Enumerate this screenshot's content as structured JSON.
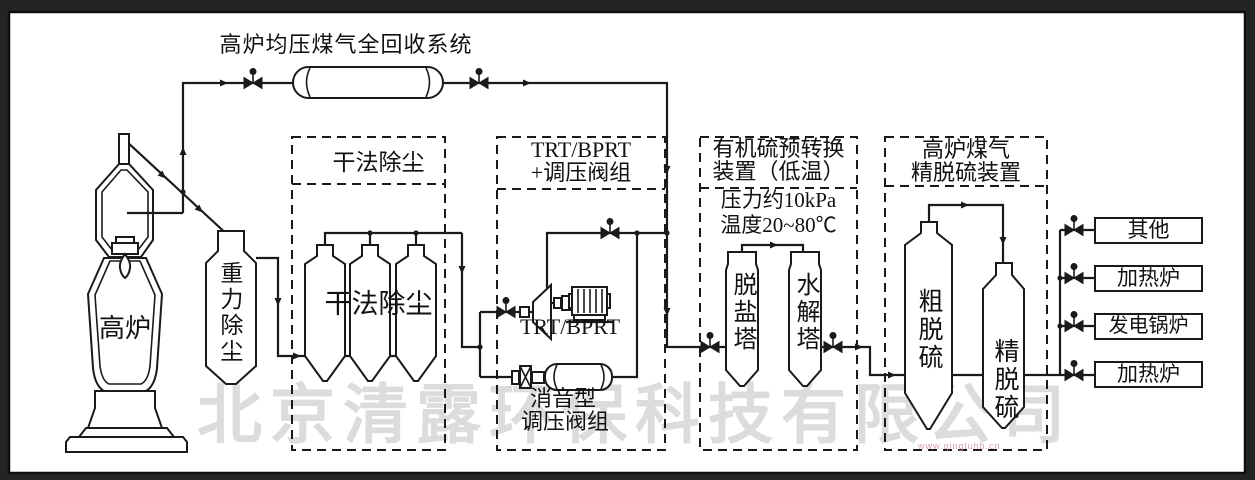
{
  "frame": {
    "background": "#242424",
    "paper": "#ffffff",
    "line_color": "#1a1a1a"
  },
  "title": "高炉均压煤气全回收系统",
  "watermark": {
    "text": "北京清露环保科技有限公司",
    "color": "#dcdcdc",
    "url": "www.qingluhb.cn",
    "url_color": "#d9a2a8"
  },
  "blast_furnace": {
    "label": "高炉"
  },
  "gravity_collector": {
    "label": "重力除尘"
  },
  "dry_dust": {
    "box_title": "干法除尘",
    "inner_label": "干法除尘"
  },
  "trt": {
    "box_title_line1": "TRT/BPRT",
    "box_title_line2": "+调压阀组",
    "turbine_label": "TRT/BPRT",
    "silencer_label_line1": "消音型",
    "silencer_label_line2": "调压阀组"
  },
  "organic_sulfur": {
    "box_title_line1": "有机硫预转换",
    "box_title_line2": "装置（低温）",
    "pressure": "压力约10kPa",
    "temperature": "温度20~80℃",
    "tower_1": "脱盐塔",
    "tower_2": "水解塔"
  },
  "fine_desulfur": {
    "box_title_line1": "高炉煤气",
    "box_title_line2": "精脱硫装置",
    "tower_1": "粗脱硫",
    "tower_2": "精脱硫"
  },
  "outputs": [
    {
      "label": "其他"
    },
    {
      "label": "加热炉"
    },
    {
      "label": "发电锅炉"
    },
    {
      "label": "加热炉"
    }
  ]
}
